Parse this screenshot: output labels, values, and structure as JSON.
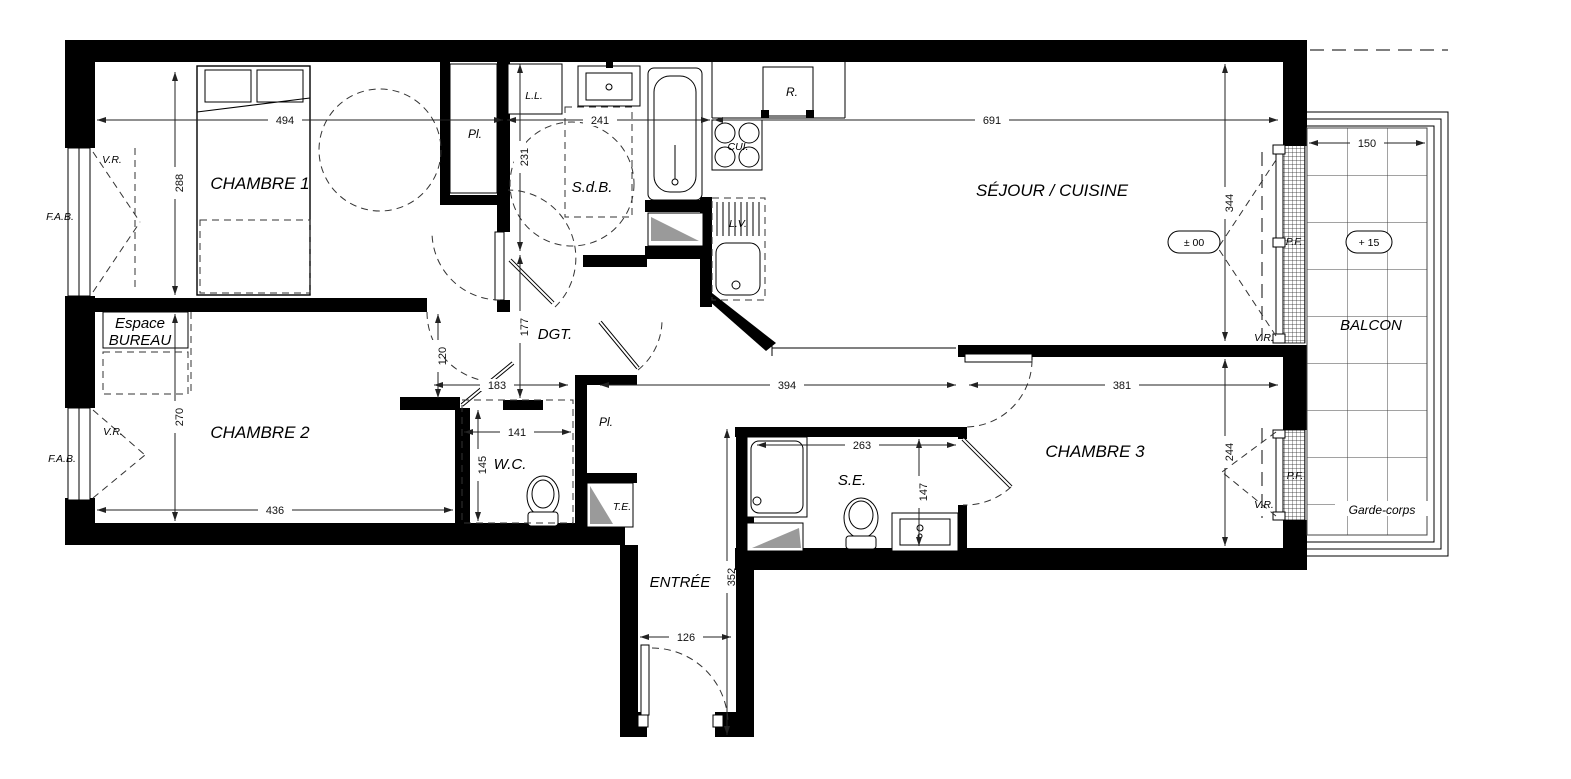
{
  "rooms": {
    "chambre1": "CHAMBRE 1",
    "espace_bureau_line1": "Espace",
    "espace_bureau_line2": "BUREAU",
    "chambre2": "CHAMBRE 2",
    "chambre3": "CHAMBRE 3",
    "sejour_cuisine": "SÉJOUR / CUISINE",
    "sdb": "S.d.B.",
    "dgt": "DGT.",
    "wc": "W.C.",
    "se": "S.E.",
    "entree": "ENTRÉE",
    "balcon": "BALCON",
    "garde_corps": "Garde-corps"
  },
  "closets": {
    "pl1": "Pl.",
    "pl2": "Pl.",
    "te": "T.E."
  },
  "appliances": {
    "ll": "L.L.",
    "r": "R.",
    "cui": "CUI.",
    "lv": "L.V."
  },
  "windows": {
    "vr1": "V.R.",
    "vr2": "V.R.",
    "vr3": "V.R.",
    "vr4": "V.R.",
    "fab1": "F.A.B.",
    "fab2": "F.A.B.",
    "pf1": "P.F.",
    "pf2": "P.F."
  },
  "levels": {
    "main": "± 00",
    "balcony": "+ 15"
  },
  "dims": {
    "d494": "494",
    "d241": "241",
    "d691": "691",
    "d150": "150",
    "d183": "183",
    "d394": "394",
    "d381": "381",
    "d141": "141",
    "d436": "436",
    "d263": "263",
    "d126": "126",
    "d288": "288",
    "d270": "270",
    "d231": "231",
    "d177": "177",
    "d120": "120",
    "d145": "145",
    "d344": "344",
    "d244": "244",
    "d147": "147",
    "d352": "352"
  }
}
